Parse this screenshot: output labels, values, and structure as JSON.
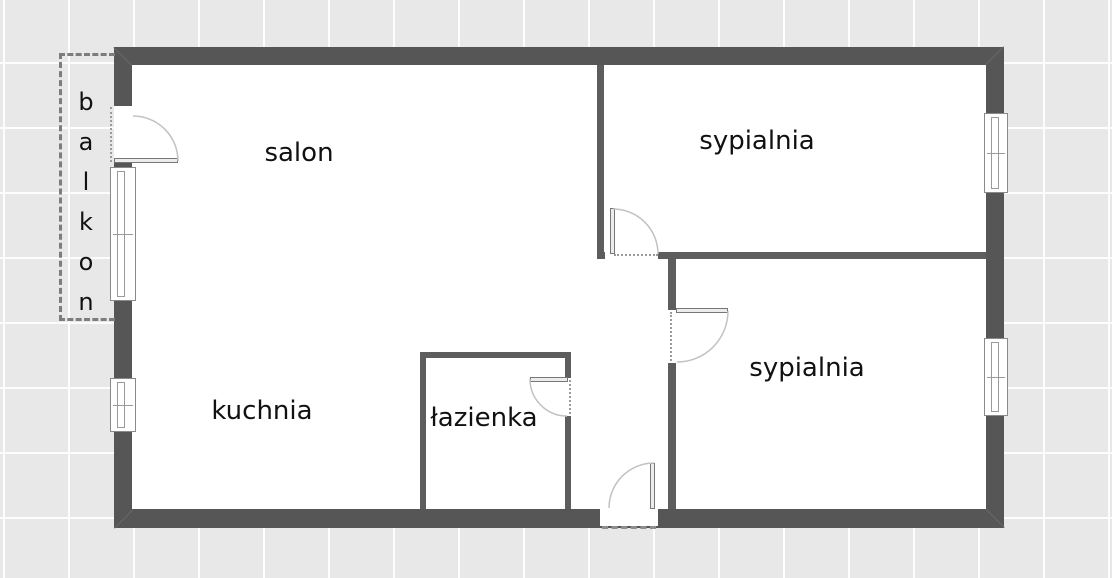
{
  "plan": {
    "type": "apartment-floor-plan",
    "rooms": {
      "salon": {
        "label": "salon"
      },
      "bedroom_top": {
        "label": "sypialnia"
      },
      "bedroom_bottom": {
        "label": "sypialnia"
      },
      "kitchen": {
        "label": "kuchnia"
      },
      "bathroom": {
        "label": "łazienka"
      },
      "balcony": {
        "label": "balkon"
      }
    },
    "counts": {
      "doors_interior": 4,
      "entrance_doors": 1,
      "balcony_doors": 1,
      "windows": 4
    },
    "colors": {
      "background": "#e9e8e8",
      "grid_line": "#ffffff",
      "exterior_wall": "#565656",
      "interior_wall": "#5d5d5d",
      "floor": "#ffffff",
      "door_arc": "#c2c2c2",
      "door_leaf": "#ececec",
      "opening_dash": "#9b9b9b",
      "balcony_dash": "#7d7d7d",
      "label_text": "#111111"
    }
  }
}
